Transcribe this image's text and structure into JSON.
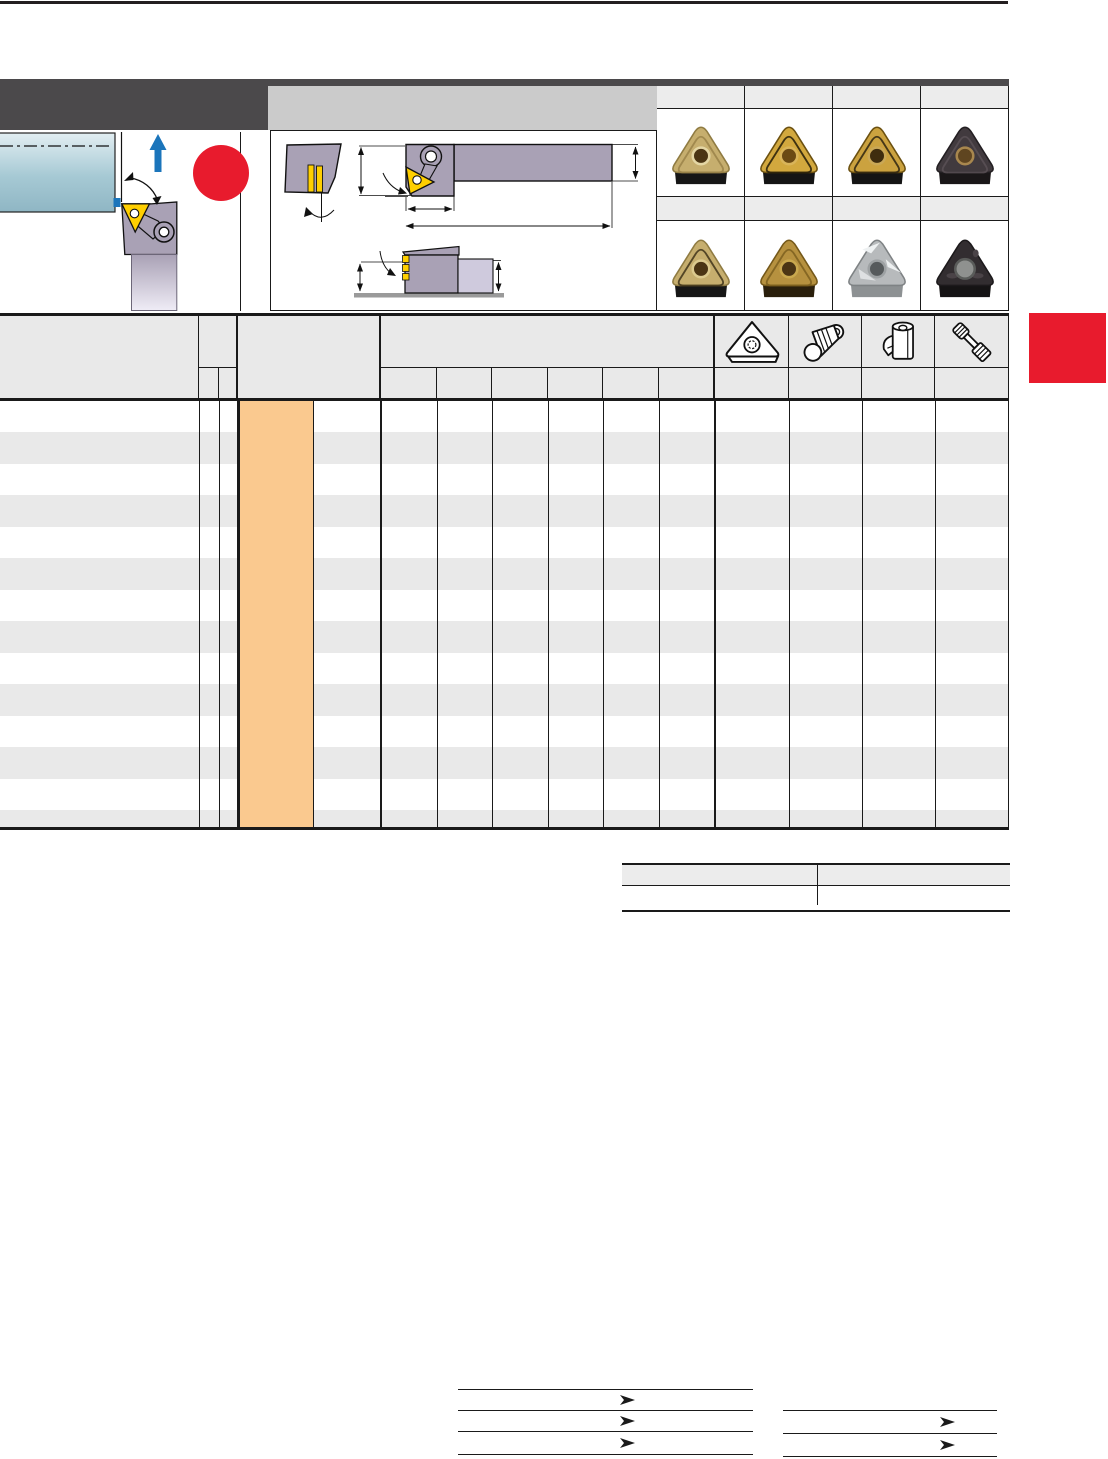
{
  "colors": {
    "page_bg": "#ffffff",
    "bar_black": "#231f20",
    "line_black": "#1a1a1a",
    "header_dark": "#4b494b",
    "header_light": "#cbcbcb",
    "table_gray": "#e9e9e9",
    "stripe_gray": "#e9e9e9",
    "gallery_gray": "#ececec",
    "accent_red": "#e81b2d",
    "highlight_orange": "#fac98f",
    "insert_yellow": "#ffcf00",
    "holder_gray": "#a9a1b5",
    "holder_light": "#cfcadd",
    "workpiece_blue_top": "#e2eef2",
    "workpiece_blue_mid": "#a6c9d4",
    "workpiece_blue_bottom": "#8fb6c4",
    "feed_arrow_blue": "#1b75bb",
    "baseline_gray": "#9a9a9a"
  },
  "application_illustration": {
    "description": "external longitudinal turning operation, workpiece with tool holder and triangular insert, upward feed arrow, red highlight circle",
    "icons": [
      "feed-direction-arrow-icon",
      "rotation-arc-icon",
      "highlight-circle"
    ]
  },
  "dimension_drawing": {
    "description": "tool holder line drawings with dimension arrows: end view, side view with shank, back-turning view",
    "views": 3
  },
  "insert_gallery": {
    "columns": 4,
    "rows": 2,
    "header_cells": 8,
    "inserts": [
      {
        "name": "insert-photo-gold-plain",
        "variant": "pattern",
        "body": "#c6ae6e",
        "edge": "#8f7b42",
        "accent": "#9a8349",
        "hole": "#4b3514",
        "rim": "#e4d6a4",
        "base": "#161616"
      },
      {
        "name": "insert-photo-gold-coated",
        "variant": "pattern",
        "body": "#d2a83e",
        "edge": "#6b5010",
        "accent": "#241c08",
        "hole": "#6b4a14",
        "rim": "#d9b459",
        "base": "#141414"
      },
      {
        "name": "insert-photo-gold-dark",
        "variant": "pattern",
        "body": "#cba23f",
        "edge": "#6b5010",
        "accent": "#2e2410",
        "hole": "#3f2d0e",
        "rim": "#caa856",
        "base": "#141414"
      },
      {
        "name": "insert-photo-black-cvd",
        "variant": "pattern",
        "body": "#413a3e",
        "edge": "#231f22",
        "accent": "#5b5156",
        "hole": "#5f4520",
        "rim": "#a8874e",
        "base": "#1a1718"
      },
      {
        "name": "insert-photo-tan",
        "variant": "pattern",
        "body": "#c6ae6e",
        "edge": "#8f7b42",
        "accent": "#40341a",
        "hole": "#4b3514",
        "rim": "#dcca8e",
        "base": "#161616"
      },
      {
        "name": "insert-photo-bronze",
        "variant": "pattern",
        "body": "#b6913f",
        "edge": "#74581a",
        "accent": "#7c5f1e",
        "hole": "#4b3514",
        "rim": "#c9a84e",
        "base": "#2a1f0c"
      },
      {
        "name": "insert-photo-silver",
        "variant": "silver",
        "body": "#b7babc",
        "edge": "#7e8284",
        "accent": "#eef1f2",
        "hole": "#565a5c",
        "rim": "#9da1a3",
        "base": "#8d9193"
      },
      {
        "name": "insert-photo-black",
        "variant": "dark",
        "body": "#322d30",
        "edge": "#1c191b",
        "accent": "#4a4347",
        "hole": "#8f918f",
        "rim": "#5a5c5a",
        "base": "#151314"
      }
    ]
  },
  "catalog_table": {
    "header_rows": 2,
    "body_striped": true,
    "highlight_column": true,
    "spare_part_icons": [
      {
        "name": "shim-icon"
      },
      {
        "name": "clamp-pin-icon"
      },
      {
        "name": "clamp-icon"
      },
      {
        "name": "screw-icon"
      }
    ]
  },
  "side_tab": {
    "shape": "rectangle",
    "purpose": "chapter index tab"
  },
  "footer_links": {
    "left_group_rows": 3,
    "right_group_rows": 2,
    "arrow_glyph": "➤"
  }
}
